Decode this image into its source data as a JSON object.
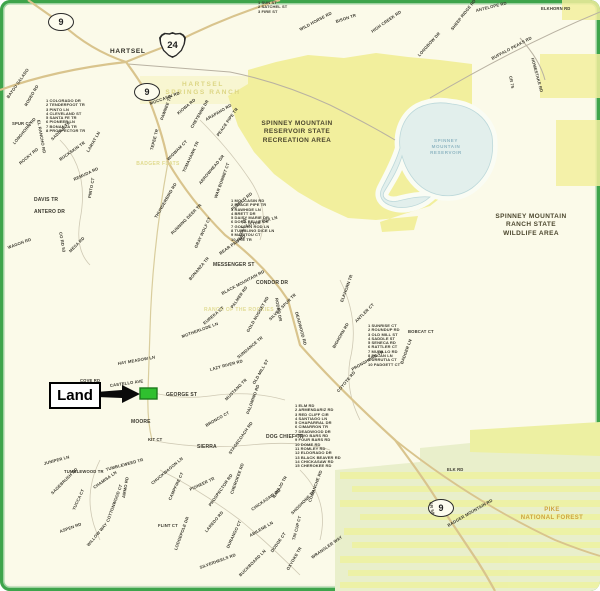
{
  "map": {
    "town": "HARTSEL",
    "land_callout": {
      "label": "Land"
    },
    "region_labels": {
      "recreation_area": [
        "SPINNEY MOUNTAIN",
        "RESERVOIR STATE",
        "RECREATION AREA"
      ],
      "wildlife_area": [
        "SPINNEY MOUNTAIN",
        "RANCH STATE",
        "WILDLIFE AREA"
      ],
      "national_forest": [
        "PIKE",
        "NATIONAL FOREST"
      ],
      "reservoir": [
        "SPINNEY",
        "MOUNTAIN",
        "RESERVOIR"
      ],
      "homestead_ranch": [
        "HARTSEL",
        "SPRINGS RANCH"
      ],
      "flats": "BADGER FLATS",
      "ranch": "RANCH OF THE ROCKIES"
    },
    "highway_shields": [
      {
        "type": "oval",
        "label": "9",
        "x": 60,
        "y": 21
      },
      {
        "type": "us",
        "label": "24",
        "x": 172,
        "y": 44
      },
      {
        "type": "oval",
        "label": "9",
        "x": 146,
        "y": 91
      },
      {
        "type": "oval",
        "label": "9",
        "x": 440,
        "y": 507
      }
    ],
    "street_lists": [
      {
        "x": 258,
        "y": 1,
        "lines": [
          "1 SUN ST",
          "2 SATCHEL ST",
          "3 FIRE ST"
        ]
      },
      {
        "x": 46,
        "y": 99,
        "lines": [
          "1 COLORADO DR",
          "2 TENDERFOOT TR",
          "3 PINTO LN",
          "4 CLEVELAND ST",
          "5 SANTA FE TR",
          "6 PIONEER LN",
          "7 BONANZA TR",
          "8 PROSPECTOR TR"
        ]
      },
      {
        "x": 231,
        "y": 199,
        "lines": [
          "1 MOCCASIN RD",
          "2 PEACE PIPE TR",
          "3 RAWHIDE LN",
          "4 BRETT DR",
          "5 DAISY MARIE DR",
          "6 DORA BELLE DR",
          "7 GOLDEN ROD LN",
          "8 TUMBLING DICE LN",
          "9 MANITOU CT",
          "10 UTE TR"
        ]
      },
      {
        "x": 368,
        "y": 324,
        "lines": [
          "1 SUNRISE CT",
          "2 ROUNDUP RD",
          "3 OLD MILL ST",
          "4 SADDLE ST",
          "5 SENECA RD",
          "6 RATTLER CT",
          "7 MURILLO RD",
          "8 PECAN LN",
          "9 URRUTIA CT",
          "10 PADGETT CT"
        ]
      },
      {
        "x": 295,
        "y": 404,
        "lines": [
          "1 ELM RD",
          "2 ARMENDARIZ RD",
          "3 RED CLIFF CIR",
          "4 SANTIAGO LN",
          "5 CHAPARRAL DR",
          "6 CIMARRON TR",
          "7 DEADWOOD DR",
          "8 TWO BARS RD",
          "9 FOUR BARS RD",
          "10 DOME RD",
          "11 ROMLEY RD",
          "12 ELDORADO DR",
          "13 BLACK BEAVER RD",
          "14 CHICKASAW RD",
          "15 CHEROKEE RD"
        ]
      }
    ],
    "street_labels": [
      [
        "BAYOU SALADO",
        8,
        96,
        -55
      ],
      [
        "RODEO RD",
        26,
        104,
        -60
      ],
      [
        "EL RANCHO RD",
        38,
        118,
        80
      ],
      [
        "SPUR CT",
        12,
        122,
        0
      ],
      [
        "LONGHORN RD",
        14,
        142,
        -50
      ],
      [
        "SADDLE TR",
        52,
        138,
        -45
      ],
      [
        "ROCKY RD",
        20,
        162,
        -40
      ],
      [
        "BUCKSKIN TR",
        60,
        158,
        -35
      ],
      [
        "LARIAT LN",
        88,
        150,
        -60
      ],
      [
        "REMUDA RD",
        74,
        178,
        -25
      ],
      [
        "DAVIS TR",
        34,
        198,
        0,
        5
      ],
      [
        "ANTERO DR",
        34,
        210,
        0,
        5
      ],
      [
        "PINTO CT",
        90,
        196,
        -80
      ],
      [
        "CO RD 53",
        60,
        230,
        80
      ],
      [
        "WAGON RD",
        8,
        246,
        -20
      ],
      [
        "MESA RD",
        70,
        250,
        -45
      ],
      [
        "MOCCASIN RD",
        150,
        102,
        -20
      ],
      [
        "PAWNEE TR",
        162,
        118,
        -70
      ],
      [
        "KIOWA RD",
        178,
        112,
        -40
      ],
      [
        "CHEYENNE DR",
        192,
        126,
        -60
      ],
      [
        "ARAPAHO RD",
        206,
        118,
        -30
      ],
      [
        "PEACE PIPE TR",
        218,
        134,
        -55
      ],
      [
        "TEPEE TR",
        152,
        148,
        -75
      ],
      [
        "WIGWAM CT",
        168,
        158,
        -45
      ],
      [
        "TOMAHAWK TR",
        184,
        170,
        -65
      ],
      [
        "ARROWHEAD DR",
        200,
        182,
        -50
      ],
      [
        "WAR BONNET CT",
        216,
        196,
        -70
      ],
      [
        "PUEBLO RD",
        232,
        208,
        -40
      ],
      [
        "THUNDERBIRD RD",
        156,
        216,
        -60
      ],
      [
        "RUNNING DEER TR",
        172,
        232,
        -45
      ],
      [
        "GRAY WOLF CT",
        196,
        246,
        -65
      ],
      [
        "BEAR PAW RD",
        220,
        252,
        -35
      ],
      [
        "EAGLE TR",
        240,
        238,
        -75
      ],
      [
        "LITTLE FOX LN",
        246,
        224,
        -15
      ],
      [
        "MESSENGER ST",
        213,
        263,
        0,
        5
      ],
      [
        "BONANZA TR",
        190,
        278,
        -50
      ],
      [
        "CONDOR DR",
        256,
        281,
        0,
        5
      ],
      [
        "BLACK MOUNTAIN RD",
        222,
        292,
        -28
      ],
      [
        "PALMER RD",
        232,
        306,
        -55
      ],
      [
        "RODEO DR",
        276,
        296,
        80
      ],
      [
        "EUREKA CT",
        204,
        322,
        -40
      ],
      [
        "MOTHERLODE LN",
        182,
        335,
        -20
      ],
      [
        "GOLD NUGGET RD",
        248,
        330,
        -60
      ],
      [
        "SILVER SPUR TR",
        270,
        318,
        -45
      ],
      [
        "DEADWOOD RD",
        296,
        310,
        75
      ],
      [
        "ELKHORN TR",
        342,
        300,
        -70
      ],
      [
        "ANTLER CT",
        356,
        320,
        -45
      ],
      [
        "BIGHORN RD",
        334,
        346,
        -60
      ],
      [
        "PRONGHORN TR",
        352,
        368,
        -30
      ],
      [
        "COYOTE RD",
        338,
        390,
        -50
      ],
      [
        "BADGER LN",
        402,
        362,
        -70
      ],
      [
        "BOBCAT CT",
        408,
        330,
        0
      ],
      [
        "COVE RD",
        80,
        379,
        0
      ],
      [
        "CASTELLO AVE",
        110,
        384,
        -8
      ],
      [
        "GEORGE ST",
        166,
        393,
        0,
        5
      ],
      [
        "MOORE",
        131,
        420,
        0,
        5
      ],
      [
        "SIERRA",
        197,
        445,
        0,
        5
      ],
      [
        "DOG CHIEF TR",
        266,
        435,
        0,
        5
      ],
      [
        "HAY MEADOW LN",
        118,
        362,
        -10
      ],
      [
        "LAZY RIVER RD",
        210,
        368,
        -15
      ],
      [
        "SUNDANCE TR",
        238,
        356,
        -40
      ],
      [
        "OLD MILL ST",
        254,
        382,
        -60
      ],
      [
        "MUSTANG TR",
        226,
        398,
        -45
      ],
      [
        "PALOMINO RD",
        248,
        412,
        -70
      ],
      [
        "BRONCO CT",
        206,
        424,
        -30
      ],
      [
        "STAGECOACH RD",
        230,
        452,
        -55
      ],
      [
        "KIT CT",
        148,
        438,
        0
      ],
      [
        "TUMBLEWEED TR",
        106,
        468,
        -15
      ],
      [
        "CHUCKWAGON LN",
        152,
        482,
        -40
      ],
      [
        "CAMPFIRE CT",
        170,
        498,
        -65
      ],
      [
        "PIONEER TR",
        190,
        488,
        -25
      ],
      [
        "PROSPECTOR RD",
        210,
        504,
        -55
      ],
      [
        "CHEROKEE RD",
        232,
        492,
        -70
      ],
      [
        "CHICKASAW RD",
        252,
        508,
        -35
      ],
      [
        "NAVAJO TR",
        274,
        496,
        -60
      ],
      [
        "SHOSHONE TR",
        292,
        512,
        -45
      ],
      [
        "COMANCHE RD",
        310,
        500,
        -70
      ],
      [
        "LAREDO RD",
        206,
        530,
        -50
      ],
      [
        "DURANGO CT",
        228,
        546,
        -65
      ],
      [
        "ABILENE LN",
        250,
        534,
        -30
      ],
      [
        "DODGE CT",
        272,
        550,
        -55
      ],
      [
        "TIN CUP CT",
        294,
        538,
        -75
      ],
      [
        "SILVERHEELS RD",
        200,
        566,
        -20
      ],
      [
        "BUCKBOARD LN",
        240,
        574,
        -45
      ],
      [
        "OXYOKE TR",
        288,
        568,
        -60
      ],
      [
        "WRANGLER WAY",
        312,
        556,
        -35
      ],
      [
        "LODGEPOLE DR",
        176,
        548,
        -70
      ],
      [
        "FLINT CT",
        158,
        524,
        0
      ],
      [
        "JUNIPER LN",
        44,
        462,
        -15
      ],
      [
        "TUMBLEWOOD TR",
        64,
        470,
        0
      ],
      [
        "SAGEBRUSH RD",
        52,
        492,
        -45
      ],
      [
        "YUCCA CT",
        74,
        508,
        -65
      ],
      [
        "CHAMISA LN",
        94,
        486,
        -35
      ],
      [
        "ASPEN RD",
        60,
        530,
        -20
      ],
      [
        "WILLOW WAY",
        88,
        544,
        -50
      ],
      [
        "COTTONWOOD CT",
        108,
        520,
        -70
      ],
      [
        "AMMO RD",
        124,
        496,
        -80
      ],
      [
        "ELKHORN RD",
        541,
        7,
        0
      ],
      [
        "ANTELOPE RD",
        476,
        9,
        -14
      ],
      [
        "SHEEP RIDGE RD",
        452,
        28,
        -52
      ],
      [
        "LONGBOW DR",
        419,
        54,
        -48
      ],
      [
        "BUFFALO PEAKS RD",
        492,
        57,
        -28
      ],
      [
        "CR 75",
        510,
        74,
        80
      ],
      [
        "HOMESTAKE RD",
        532,
        56,
        75
      ],
      [
        "WILD HORSE RD",
        300,
        28,
        -28
      ],
      [
        "BISON TR",
        336,
        20,
        -18
      ],
      [
        "HIGH CREEK RD",
        372,
        30,
        -35
      ],
      [
        "ELK RD",
        447,
        468,
        0
      ],
      [
        "CR 59",
        430,
        500,
        78
      ],
      [
        "BADGER MOUNTAIN RD",
        448,
        524,
        -30
      ]
    ],
    "colors": {
      "frame_green": "#3ea44b",
      "map_cream": "#fbfae9",
      "state_land_yellow": "#f2ef9d",
      "forest_zone_green": "#e9efcb",
      "reservoir_blue": "#e2efec",
      "highway_tan": "#d9c48d",
      "land_parcel_green": "#2fc02f",
      "label_ink": "#3a382e"
    }
  }
}
